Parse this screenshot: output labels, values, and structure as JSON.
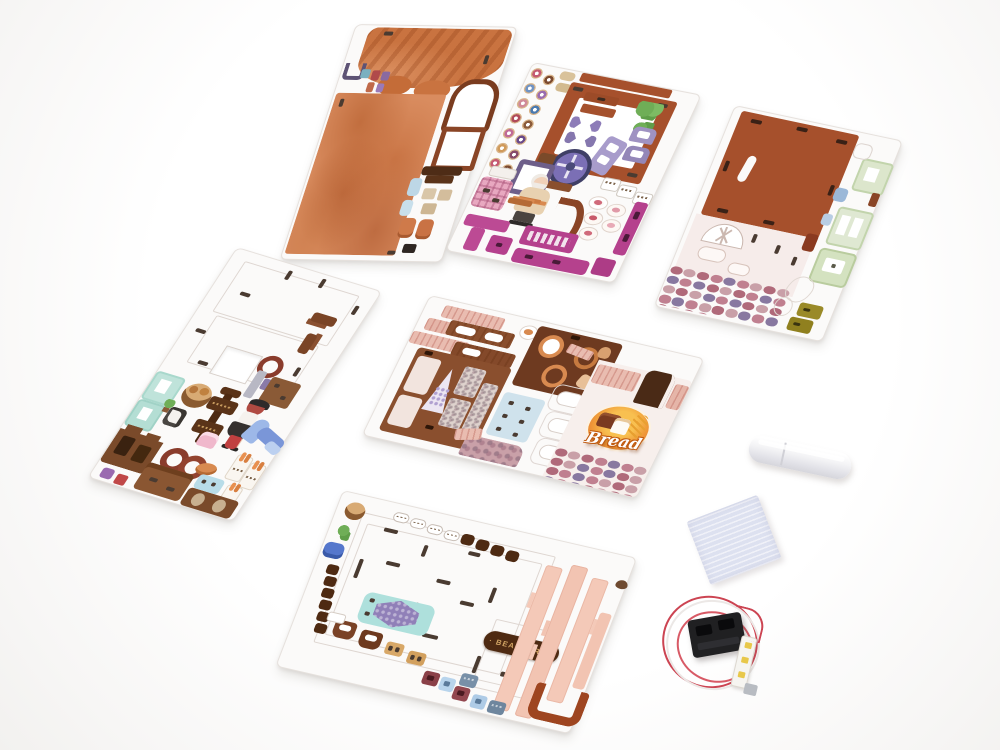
{
  "scene": {
    "description": "Product photo of a DIY miniature bakery (bear bakery) 3D wooden puzzle kit: six laser-cut printed plywood sheets laid diagonally on a white background, plus a white glue stick, a pale-blue foam sanding pad, and a battery box wired to an LED strip.",
    "background_color": "#f7f6f5"
  },
  "texts": {
    "bread_sign": "Bread",
    "bearkery_sign": "· BEARKERY ·"
  },
  "components": {
    "sheets": [
      "roof-and-watercolor-panel-sheet",
      "donuts-furniture-and-baker-sheet",
      "roof-panel-and-stone-wall-sheet",
      "sticker-and-furniture-sheet",
      "counter-and-bread-storefront-sheet",
      "floor-and-pillars-bearkery-sheet"
    ],
    "accessories": [
      "glue-stick",
      "foam-pad",
      "battery-box-with-led-strip"
    ]
  },
  "colors": {
    "terracotta": "#a6502c",
    "watercolor_orange": "#d98c5f",
    "croissant": "#c97340",
    "dark_sign_brown": "#4e2a12",
    "sign_text_tan": "#d2a565",
    "magenta": "#b5418d",
    "lavender": "#9f92c2",
    "mint": "#a8d8cc",
    "sage": "#c2d4ac",
    "salmon": "#f4c9b8",
    "wood_brown": "#8a4f2e",
    "pink_wood": "#e9bcb0",
    "led_yellow": "#e8c84a",
    "wire_red": "#cc4452",
    "stones": [
      "#b06a7a",
      "#8a5a44",
      "#9b7cae",
      "#c08090",
      "#7d5a6a",
      "#b09060",
      "#c9a0a8",
      "#6e4a56",
      "#a05060",
      "#8878a0",
      "#c87888",
      "#74506a"
    ],
    "donut_rings": [
      "#c55a72",
      "#7b4a2f",
      "#6f93c4",
      "#9b6cb0",
      "#d08a9a",
      "#4a7ab0",
      "#b04a5a",
      "#8a5a3a",
      "#c06a98",
      "#6a4a8a",
      "#d09a5a",
      "#884a6a"
    ]
  }
}
